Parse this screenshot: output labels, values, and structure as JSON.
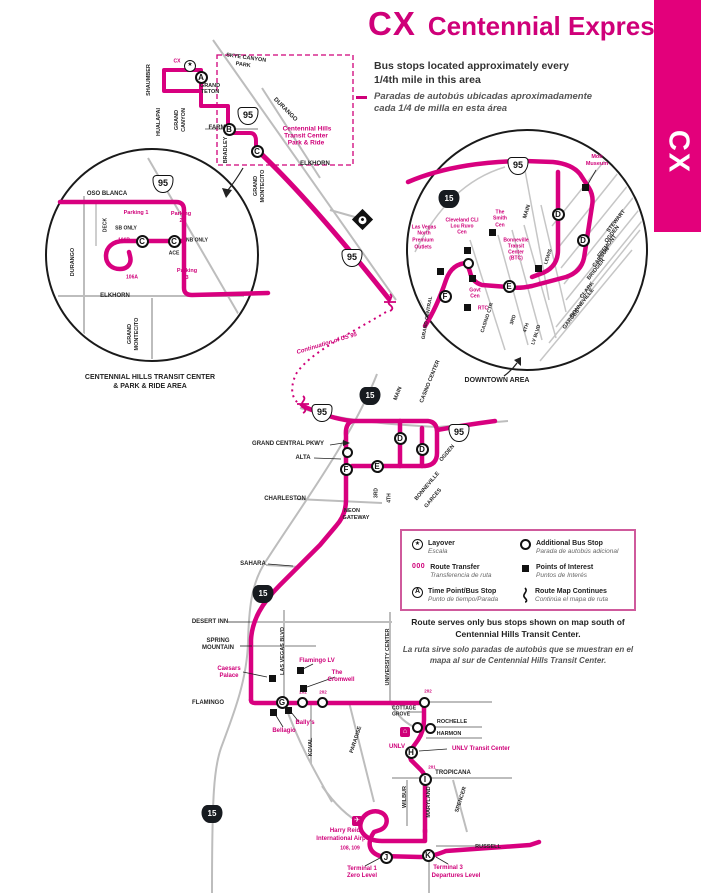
{
  "colors": {
    "accent": "#cf0079",
    "route": "#d8007f",
    "banner": "#e3007b",
    "road": "#bdbdbd",
    "ink": "#1a1a1a"
  },
  "header": {
    "route_code": "CX",
    "route_name": "Centennial Express",
    "banner_code": "CX"
  },
  "intro": {
    "en_line1": "Bus stops located approximately every",
    "en_line2": "1/4th mile in this area",
    "es_line1": "Paradas de autobús ubicadas aproximadamente",
    "es_line2": "cada 1/4 de milla en esta área"
  },
  "legend": {
    "items": [
      {
        "icon": "layover-icon",
        "label": "Layover",
        "label_es": "Escala"
      },
      {
        "icon": "route-transfer",
        "symbol": "000",
        "label": "Route Transfer",
        "label_es": "Transferencia de ruta"
      },
      {
        "icon": "time-point",
        "symbol": "A",
        "label": "Time Point/Bus Stop",
        "label_es": "Punto de tiempo/Parada"
      },
      {
        "icon": "additional-stop",
        "label": "Additional Bus Stop",
        "label_es": "Parada de autobús adicional"
      },
      {
        "icon": "points-of-interest",
        "label": "Points of Interest",
        "label_es": "Puntos de Interés"
      },
      {
        "icon": "route-continues",
        "label": "Route Map Continues",
        "label_es": "Continúa el mapa de ruta"
      }
    ]
  },
  "captions": {
    "left_inset_line1": "CENTENNIAL HILLS TRANSIT CENTER",
    "left_inset_line2": "& PARK & RIDE AREA",
    "right_inset": "DOWNTOWN AREA"
  },
  "notes": {
    "en_line1": "Route serves only bus stops shown on map south of",
    "en_line2": "Centennial Hills Transit Center.",
    "es_line1": "La ruta sirve solo paradas de autobús que se muestran en el",
    "es_line2": "mapa al sur de Centennial Hills Transit Center."
  },
  "map": {
    "street_labels": [
      {
        "t": "SKYE CANYON",
        "x": 246,
        "y": 59,
        "r": 8,
        "s": 5.5
      },
      {
        "t": "PARK",
        "x": 243,
        "y": 66,
        "r": 8,
        "s": 5.5
      },
      {
        "t": "GRAND",
        "x": 210,
        "y": 87,
        "s": 5.5
      },
      {
        "t": "TETON",
        "x": 210,
        "y": 93,
        "s": 5.5
      },
      {
        "t": "SHAUMBER",
        "x": 150,
        "y": 80,
        "r": -90,
        "s": 5.5
      },
      {
        "t": "HUALAPAI",
        "x": 160,
        "y": 122,
        "r": -90,
        "s": 5.5
      },
      {
        "t": "GRAND",
        "x": 178,
        "y": 120,
        "r": -90,
        "s": 5.5
      },
      {
        "t": "CANYON",
        "x": 185,
        "y": 120,
        "r": -90,
        "s": 5.5
      },
      {
        "t": "FARM",
        "x": 217,
        "y": 128,
        "s": 6
      },
      {
        "t": "BRADLEY",
        "x": 227,
        "y": 150,
        "r": -90,
        "s": 5.5
      },
      {
        "t": "DURANGO",
        "x": 285,
        "y": 110,
        "r": 45,
        "s": 6
      },
      {
        "t": "ELKHORN",
        "x": 315,
        "y": 164,
        "s": 6
      },
      {
        "t": "GRAND",
        "x": 257,
        "y": 186,
        "r": -90,
        "s": 5.5
      },
      {
        "t": "MONTECITO",
        "x": 264,
        "y": 186,
        "r": -90,
        "s": 5.5
      },
      {
        "t": "OSO BLANCA",
        "x": 107,
        "y": 194,
        "s": 6
      },
      {
        "t": "DECK",
        "x": 106,
        "y": 225,
        "r": -90,
        "s": 5
      },
      {
        "t": "SB ONLY",
        "x": 126,
        "y": 229,
        "s": 5
      },
      {
        "t": "NB ONLY",
        "x": 197,
        "y": 241,
        "s": 5
      },
      {
        "t": "ACE",
        "x": 174,
        "y": 254,
        "s": 5
      },
      {
        "t": "DURANGO",
        "x": 74,
        "y": 262,
        "r": -90,
        "s": 5.5
      },
      {
        "t": "ELKHORN",
        "x": 115,
        "y": 296,
        "s": 6
      },
      {
        "t": "GRAND",
        "x": 131,
        "y": 334,
        "r": -90,
        "s": 5.5
      },
      {
        "t": "MONTECITO",
        "x": 138,
        "y": 334,
        "r": -90,
        "s": 5.5
      },
      {
        "t": "MAIN",
        "x": 528,
        "y": 212,
        "r": -72,
        "s": 5.5
      },
      {
        "t": "STEWART",
        "x": 617,
        "y": 222,
        "r": -52,
        "s": 5.5
      },
      {
        "t": "OGDEN",
        "x": 613,
        "y": 235,
        "r": -52,
        "s": 5.5
      },
      {
        "t": "FREMONT",
        "x": 608,
        "y": 247,
        "r": -52,
        "s": 5.5
      },
      {
        "t": "CARSON",
        "x": 602,
        "y": 258,
        "r": -52,
        "s": 5.5
      },
      {
        "t": "BRIDGER",
        "x": 597,
        "y": 270,
        "r": -52,
        "s": 5.5
      },
      {
        "t": "CLARK",
        "x": 588,
        "y": 291,
        "r": -52,
        "s": 5.5
      },
      {
        "t": "BONNEVILLE",
        "x": 583,
        "y": 304,
        "r": -52,
        "s": 5.5
      },
      {
        "t": "GARCES",
        "x": 572,
        "y": 320,
        "r": -52,
        "s": 5.5
      },
      {
        "t": "LEWIS",
        "x": 549,
        "y": 257,
        "r": -72,
        "s": 5
      },
      {
        "t": "CASINO CTR",
        "x": 488,
        "y": 318,
        "r": -72,
        "s": 5
      },
      {
        "t": "3RD",
        "x": 514,
        "y": 320,
        "r": -72,
        "s": 5
      },
      {
        "t": "4TH",
        "x": 527,
        "y": 328,
        "r": -72,
        "s": 5
      },
      {
        "t": "LV BLVD",
        "x": 537,
        "y": 335,
        "r": -72,
        "s": 5
      },
      {
        "t": "GRAND CENTRAL",
        "x": 428,
        "y": 318,
        "r": -80,
        "s": 5
      },
      {
        "t": "MAIN",
        "x": 399,
        "y": 394,
        "r": -68,
        "s": 5.5
      },
      {
        "t": "CASINO CENTER",
        "x": 431,
        "y": 382,
        "r": -68,
        "s": 5.5
      },
      {
        "t": "OGDEN",
        "x": 448,
        "y": 454,
        "r": -50,
        "s": 5.5
      },
      {
        "t": "GRAND CENTRAL PKWY",
        "x": 288,
        "y": 444,
        "s": 6
      },
      {
        "t": "ALTA",
        "x": 303,
        "y": 458,
        "s": 6
      },
      {
        "t": "CHARLESTON",
        "x": 285,
        "y": 499,
        "s": 6
      },
      {
        "t": "NEON",
        "x": 352,
        "y": 512,
        "s": 5.5
      },
      {
        "t": "GATEWAY",
        "x": 356,
        "y": 519,
        "s": 5.5
      },
      {
        "t": "BONNEVILLE",
        "x": 428,
        "y": 487,
        "r": -50,
        "s": 5.5
      },
      {
        "t": "GARCES",
        "x": 434,
        "y": 499,
        "r": -50,
        "s": 5.5
      },
      {
        "t": "3RD",
        "x": 377,
        "y": 493,
        "r": -90,
        "s": 5
      },
      {
        "t": "4TH",
        "x": 390,
        "y": 498,
        "r": -90,
        "s": 5
      },
      {
        "t": "SAHARA",
        "x": 253,
        "y": 564,
        "s": 6
      },
      {
        "t": "DESERT INN",
        "x": 210,
        "y": 622,
        "s": 6
      },
      {
        "t": "SPRING",
        "x": 218,
        "y": 641,
        "s": 6
      },
      {
        "t": "MOUNTAIN",
        "x": 218,
        "y": 648,
        "s": 6
      },
      {
        "t": "LAS VEGAS BLVD",
        "x": 284,
        "y": 651,
        "r": -90,
        "s": 5.5
      },
      {
        "t": "FLAMINGO",
        "x": 208,
        "y": 703,
        "s": 6
      },
      {
        "t": "KOVAL",
        "x": 312,
        "y": 747,
        "r": -90,
        "s": 5.5
      },
      {
        "t": "PARADISE",
        "x": 357,
        "y": 740,
        "r": -72,
        "s": 5.5
      },
      {
        "t": "UNIVERSITY CENTER",
        "x": 389,
        "y": 657,
        "r": -90,
        "s": 5.5
      },
      {
        "t": "COTTAGE",
        "x": 404,
        "y": 709,
        "s": 5
      },
      {
        "t": "GROVE",
        "x": 401,
        "y": 715,
        "s": 5
      },
      {
        "t": "ROCHELLE",
        "x": 452,
        "y": 723,
        "s": 5.5
      },
      {
        "t": "HARMON",
        "x": 449,
        "y": 735,
        "s": 5.5
      },
      {
        "t": "TROPICANA",
        "x": 453,
        "y": 773,
        "s": 6
      },
      {
        "t": "WILBUR",
        "x": 406,
        "y": 797,
        "r": -90,
        "s": 5.5
      },
      {
        "t": "MARYLAND",
        "x": 430,
        "y": 802,
        "r": -90,
        "s": 5.5
      },
      {
        "t": "SPENCER",
        "x": 462,
        "y": 800,
        "r": -72,
        "s": 5.5
      },
      {
        "t": "RUSSELL",
        "x": 488,
        "y": 848,
        "s": 5.5
      }
    ],
    "poi_labels": [
      {
        "t": "CX",
        "x": 177,
        "y": 62,
        "s": 5,
        "n": "route-terminal-label"
      },
      {
        "t": "Centennial Hills",
        "x": 307,
        "y": 130,
        "s": 6.5
      },
      {
        "t": "Transit Center",
        "x": 306,
        "y": 137,
        "s": 6.5
      },
      {
        "t": "Park & Ride",
        "x": 306,
        "y": 144,
        "s": 6.5
      },
      {
        "t": "Parking 1",
        "x": 136,
        "y": 214,
        "s": 5.5
      },
      {
        "t": "106B",
        "x": 124,
        "y": 241,
        "s": 5,
        "n": "route-transfer-label"
      },
      {
        "t": "Parking",
        "x": 181,
        "y": 215,
        "s": 5.5
      },
      {
        "t": "2",
        "x": 181,
        "y": 222,
        "s": 5.5
      },
      {
        "t": "Parking",
        "x": 187,
        "y": 272,
        "s": 5.5
      },
      {
        "t": "3",
        "x": 187,
        "y": 279,
        "s": 5.5
      },
      {
        "t": "106A",
        "x": 132,
        "y": 278,
        "s": 5,
        "n": "route-transfer-label"
      },
      {
        "t": "Mob",
        "x": 597,
        "y": 158,
        "s": 5.5
      },
      {
        "t": "Museum",
        "x": 597,
        "y": 165,
        "s": 5.5
      },
      {
        "t": "Las Vegas",
        "x": 424,
        "y": 228,
        "s": 5
      },
      {
        "t": "North",
        "x": 424,
        "y": 234,
        "s": 5
      },
      {
        "t": "Premium",
        "x": 423,
        "y": 241,
        "s": 5
      },
      {
        "t": "Outlets",
        "x": 423,
        "y": 248,
        "s": 5
      },
      {
        "t": "Cleveland CLI",
        "x": 462,
        "y": 221,
        "s": 5
      },
      {
        "t": "Lou Ruvo",
        "x": 462,
        "y": 227,
        "s": 5
      },
      {
        "t": "Cen",
        "x": 462,
        "y": 233,
        "s": 5
      },
      {
        "t": "The",
        "x": 500,
        "y": 213,
        "s": 5
      },
      {
        "t": "Smith",
        "x": 500,
        "y": 219,
        "s": 5
      },
      {
        "t": "Cen",
        "x": 500,
        "y": 226,
        "s": 5
      },
      {
        "t": "Bonneville",
        "x": 516,
        "y": 241,
        "s": 5
      },
      {
        "t": "Transit",
        "x": 516,
        "y": 247,
        "s": 5
      },
      {
        "t": "Center",
        "x": 516,
        "y": 253,
        "s": 5
      },
      {
        "t": "(BTC)",
        "x": 516,
        "y": 259,
        "s": 5
      },
      {
        "t": "Govt",
        "x": 475,
        "y": 291,
        "s": 5
      },
      {
        "t": "Cen",
        "x": 475,
        "y": 297,
        "s": 5
      },
      {
        "t": "RTC",
        "x": 483,
        "y": 309,
        "s": 5
      },
      {
        "t": "RJC",
        "x": 543,
        "y": 284,
        "s": 4.5
      },
      {
        "t": "Continuation of US 95",
        "x": 327,
        "y": 344,
        "r": -17,
        "s": 6,
        "it": 1
      },
      {
        "t": "Caesars",
        "x": 229,
        "y": 669,
        "s": 6
      },
      {
        "t": "Palace",
        "x": 229,
        "y": 676,
        "s": 6
      },
      {
        "t": "Flamingo LV",
        "x": 317,
        "y": 661,
        "s": 6
      },
      {
        "t": "The",
        "x": 337,
        "y": 673,
        "s": 6
      },
      {
        "t": "Cromwell",
        "x": 341,
        "y": 680,
        "s": 6
      },
      {
        "t": "Bally's",
        "x": 305,
        "y": 723,
        "s": 6
      },
      {
        "t": "Bellagio",
        "x": 284,
        "y": 731,
        "s": 6
      },
      {
        "t": "UNLV",
        "x": 397,
        "y": 747,
        "s": 6
      },
      {
        "t": "UNLV Transit Center",
        "x": 481,
        "y": 749,
        "s": 6
      },
      {
        "t": "Harry Reid",
        "x": 345,
        "y": 831,
        "s": 6
      },
      {
        "t": "International Airport",
        "x": 345,
        "y": 839,
        "s": 6
      },
      {
        "t": "108, 109",
        "x": 350,
        "y": 849,
        "s": 5,
        "n": "route-transfer-label"
      },
      {
        "t": "Terminal 1",
        "x": 362,
        "y": 869,
        "s": 6
      },
      {
        "t": "Zero Level",
        "x": 362,
        "y": 876,
        "s": 6
      },
      {
        "t": "Terminal 3",
        "x": 448,
        "y": 868,
        "s": 6
      },
      {
        "t": "Departures Level",
        "x": 456,
        "y": 876,
        "s": 6
      },
      {
        "t": "202",
        "x": 303,
        "y": 693,
        "s": 4.5,
        "n": "route-transfer-label"
      },
      {
        "t": "202",
        "x": 323,
        "y": 693,
        "s": 4.5,
        "n": "route-transfer-label"
      },
      {
        "t": "202",
        "x": 428,
        "y": 692,
        "s": 4.5,
        "n": "route-transfer-label"
      },
      {
        "t": "201",
        "x": 432,
        "y": 768,
        "s": 4.5,
        "n": "route-transfer-label"
      }
    ],
    "timepoints": [
      {
        "l": "A",
        "x": 201,
        "y": 77
      },
      {
        "l": "B",
        "x": 229,
        "y": 129
      },
      {
        "l": "C",
        "x": 257,
        "y": 151
      },
      {
        "l": "C",
        "x": 142,
        "y": 241
      },
      {
        "l": "C",
        "x": 174,
        "y": 241
      },
      {
        "l": "D",
        "x": 558,
        "y": 214
      },
      {
        "l": "D",
        "x": 583,
        "y": 240
      },
      {
        "l": "E",
        "x": 509,
        "y": 286
      },
      {
        "l": "F",
        "x": 445,
        "y": 296
      },
      {
        "l": "D",
        "x": 400,
        "y": 438
      },
      {
        "l": "D",
        "x": 422,
        "y": 449
      },
      {
        "l": "E",
        "x": 377,
        "y": 466
      },
      {
        "l": "F",
        "x": 346,
        "y": 469
      },
      {
        "l": "G",
        "x": 282,
        "y": 702
      },
      {
        "l": "H",
        "x": 411,
        "y": 752
      },
      {
        "l": "I",
        "x": 425,
        "y": 779
      },
      {
        "l": "J",
        "x": 386,
        "y": 857
      },
      {
        "l": "K",
        "x": 428,
        "y": 855
      }
    ],
    "stops": [
      {
        "x": 468,
        "y": 263
      },
      {
        "x": 347,
        "y": 452
      },
      {
        "x": 302,
        "y": 702
      },
      {
        "x": 322,
        "y": 702
      },
      {
        "x": 424,
        "y": 702
      },
      {
        "x": 417,
        "y": 727
      },
      {
        "x": 430,
        "y": 728
      }
    ],
    "poi_squares": [
      {
        "x": 585,
        "y": 187
      },
      {
        "x": 467,
        "y": 250
      },
      {
        "x": 492,
        "y": 232
      },
      {
        "x": 440,
        "y": 271
      },
      {
        "x": 472,
        "y": 278
      },
      {
        "x": 467,
        "y": 307
      },
      {
        "x": 538,
        "y": 268
      },
      {
        "x": 272,
        "y": 678
      },
      {
        "x": 300,
        "y": 670
      },
      {
        "x": 303,
        "y": 688
      },
      {
        "x": 288,
        "y": 710
      },
      {
        "x": 273,
        "y": 712
      }
    ],
    "shields": [
      {
        "v": "95",
        "t": "us95",
        "x": 248,
        "y": 116
      },
      {
        "v": "95",
        "t": "us95",
        "x": 163,
        "y": 184
      },
      {
        "v": "95",
        "t": "us95",
        "x": 352,
        "y": 258
      },
      {
        "v": "95",
        "t": "us95",
        "x": 322,
        "y": 413
      },
      {
        "v": "95",
        "t": "us95",
        "x": 459,
        "y": 433
      },
      {
        "v": "95",
        "t": "us95",
        "x": 518,
        "y": 166
      },
      {
        "v": "15",
        "t": "i15",
        "x": 449,
        "y": 199
      },
      {
        "v": "15",
        "t": "i15",
        "x": 370,
        "y": 396
      },
      {
        "v": "15",
        "t": "i15",
        "x": 263,
        "y": 594
      },
      {
        "v": "15",
        "t": "i15",
        "x": 212,
        "y": 814
      }
    ],
    "layovers": [
      {
        "x": 190,
        "y": 66
      },
      {
        "x": 362,
        "y": 219,
        "d": 1
      }
    ],
    "icons": [
      {
        "g": "✈",
        "x": 357,
        "y": 821,
        "n": "airport-icon"
      },
      {
        "g": "⌂",
        "x": 405,
        "y": 732,
        "n": "unlv-building-icon"
      }
    ]
  }
}
